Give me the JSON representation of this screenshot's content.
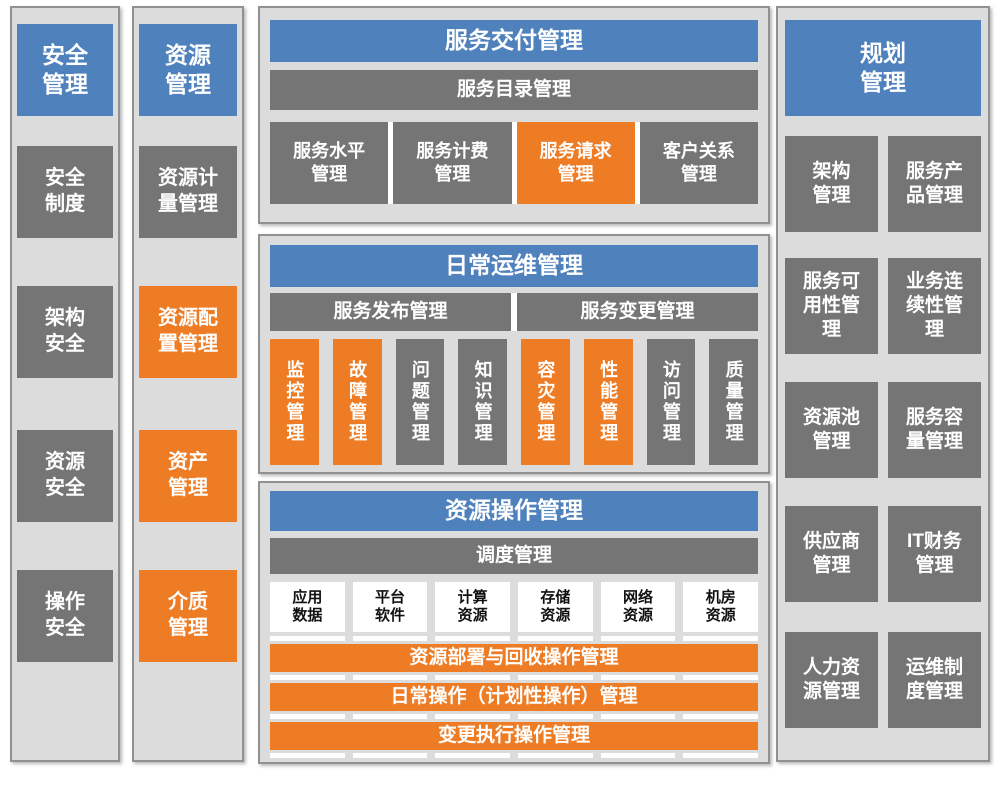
{
  "colors": {
    "header_blue": "#4f81bd",
    "block_gray": "#757575",
    "block_orange": "#ee7c25",
    "panel_bg": "#dcdcdc",
    "panel_border": "#919191",
    "white_block": "#ffffff"
  },
  "security": {
    "header": "安全\n管理",
    "items": [
      "安全\n制度",
      "架构\n安全",
      "资源\n安全",
      "操作\n安全"
    ]
  },
  "resource": {
    "header": "资源\n管理",
    "items": [
      {
        "label": "资源计\n量管理",
        "color": "gray"
      },
      {
        "label": "资源配\n置管理",
        "color": "orange"
      },
      {
        "label": "资产\n管理",
        "color": "orange"
      },
      {
        "label": "介质\n管理",
        "color": "orange"
      }
    ]
  },
  "service_delivery": {
    "header": "服务交付管理",
    "subheader": "服务目录管理",
    "items": [
      {
        "label": "服务水平\n管理",
        "color": "gray"
      },
      {
        "label": "服务计费\n管理",
        "color": "gray"
      },
      {
        "label": "服务请求\n管理",
        "color": "orange"
      },
      {
        "label": "客户关系\n管理",
        "color": "gray"
      }
    ]
  },
  "daily_ops": {
    "header": "日常运维管理",
    "bars": [
      "服务发布管理",
      "服务变更管理"
    ],
    "items": [
      {
        "label": "监控管理",
        "color": "orange"
      },
      {
        "label": "故障管理",
        "color": "orange"
      },
      {
        "label": "问题管理",
        "color": "gray"
      },
      {
        "label": "知识管理",
        "color": "gray"
      },
      {
        "label": "容灾管理",
        "color": "orange"
      },
      {
        "label": "性能管理",
        "color": "orange"
      },
      {
        "label": "访问管理",
        "color": "gray"
      },
      {
        "label": "质量管理",
        "color": "gray"
      }
    ]
  },
  "resource_ops": {
    "header": "资源操作管理",
    "subheader": "调度管理",
    "resources": [
      "应用\n数据",
      "平台\n软件",
      "计算\n资源",
      "存储\n资源",
      "网络\n资源",
      "机房\n资源"
    ],
    "bars": [
      "资源部署与回收操作管理",
      "日常操作（计划性操作）管理",
      "变更执行操作管理"
    ]
  },
  "planning": {
    "header": "规划\n管理",
    "rows": [
      [
        "架构\n管理",
        "服务产\n品管理"
      ],
      [
        "服务可\n用性管\n理",
        "业务连\n续性管\n理"
      ],
      [
        "资源池\n管理",
        "服务容\n量管理"
      ],
      [
        "供应商\n管理",
        "IT财务\n管理"
      ],
      [
        "人力资\n源管理",
        "运维制\n度管理"
      ]
    ]
  }
}
